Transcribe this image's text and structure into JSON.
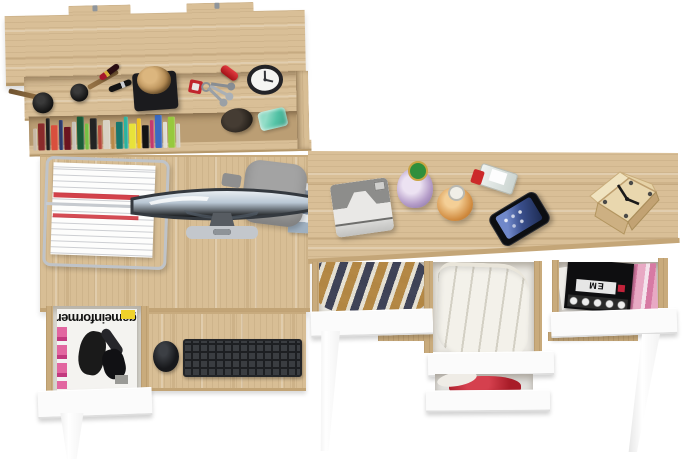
{
  "meta": {
    "description": "Top-down product render of an oak home-office set: wall shelf, gaming desk with keyboard tray, and three-drawer desk, white drawer fronts and legs",
    "view": "top-down"
  },
  "palette": {
    "background": "#ffffff",
    "oak_wood": "#d9bf97",
    "oak_wood_dark": "#c9ab7c",
    "drawer_white": "#fbfbfb",
    "keyboard_black": "#3a3d41",
    "accent_red": "#c0242c",
    "garment_red": "#b0222e",
    "plaid_navy": "#3c3c52",
    "plaid_tan": "#b2843e",
    "glass_teal": "#4cc7ab",
    "screen_gray_blue": "#9fb2c2"
  },
  "magazine": {
    "title": "gameinformer"
  },
  "right_drawer_magazine": {
    "label": "EM"
  },
  "shelf": {
    "name": "wall shelf with books and accessories",
    "book_colors": [
      "#c8b9a6",
      "#8a2b2b",
      "#1f1f1f",
      "#d94f3d",
      "#2c3a6b",
      "#6b1420",
      "#c7c2b8",
      "#1a5c38",
      "#77c043",
      "#232323",
      "#b5483a",
      "#d8d2c4",
      "#b98a4a",
      "#17776f",
      "#2bb3a0",
      "#e8e23a",
      "#f0c020",
      "#141414",
      "#c23b6e",
      "#3b6bc2",
      "#e0ddd2",
      "#97c93d",
      "#d2cfc6"
    ],
    "items": [
      "makeup brushes",
      "lipsticks",
      "black tray with rope ball",
      "keychain with keys",
      "red pocket knife",
      "alarm clock",
      "row of books",
      "dark beanie hat",
      "teal glass jar"
    ]
  },
  "left_desk": {
    "name": "desk with keyboard tray and magazine drawer",
    "items": [
      "wire document tray with papers",
      "curved widescreen monitor",
      "gray office chair",
      "stack of booklets",
      "black keyboard",
      "black mouse",
      "open drawer with gameinformer magazine"
    ]
  },
  "right_desk": {
    "name": "three-drawer desk",
    "items": [
      "instant camera",
      "green-cap perfume bottle",
      "amber perfume bottle",
      "red-cap perfume bottle",
      "smartphone",
      "wooden cube clock"
    ],
    "drawers": [
      "plaid shirt",
      "white folded trousers",
      "red garment",
      "music magazines"
    ]
  }
}
